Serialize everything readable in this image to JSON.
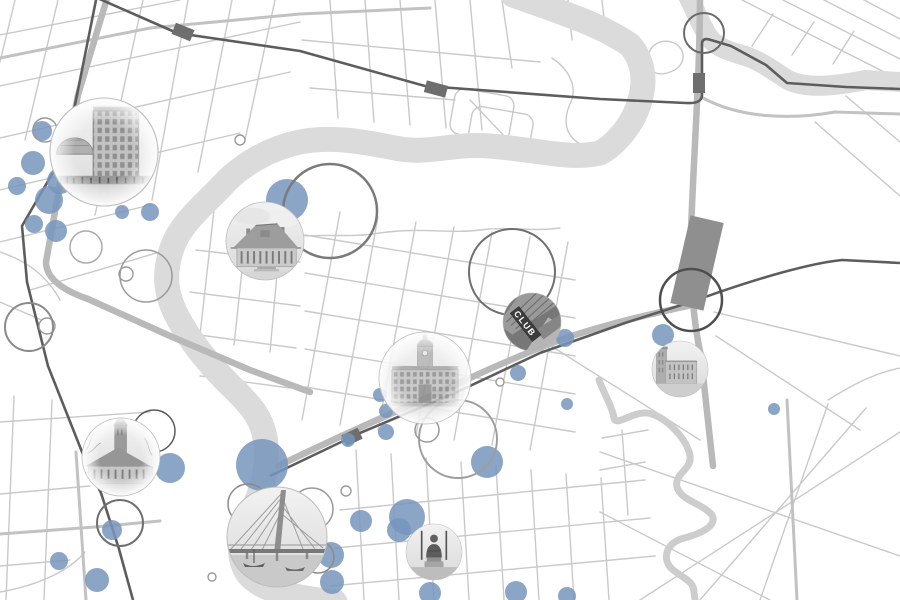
{
  "canvas": {
    "width": 900,
    "height": 600
  },
  "club_sign_text": "CLUB",
  "colors": {
    "background": "#ffffff",
    "bubble": "#7795bd",
    "river": "#dbdbdb",
    "railway": "#5d5d5d",
    "road_thin": "#c9c9c9",
    "road_medium": "#c2c2c2",
    "road_thick": "#b9b9b9",
    "station": "#6e6e6e",
    "dark_block": "#8f8f8f",
    "photo_edge": "#bdbdbd"
  },
  "bubbles": [
    [
      42,
      131,
      10
    ],
    [
      33,
      163,
      12
    ],
    [
      61,
      165,
      7
    ],
    [
      17,
      186,
      9
    ],
    [
      60,
      181,
      13
    ],
    [
      49,
      200,
      14
    ],
    [
      34,
      224,
      9
    ],
    [
      56,
      231,
      11
    ],
    [
      97,
      197,
      8
    ],
    [
      122,
      212,
      7
    ],
    [
      150,
      212,
      9
    ],
    [
      287,
      200,
      21
    ],
    [
      380,
      395,
      7
    ],
    [
      386,
      411,
      7
    ],
    [
      386,
      432,
      8
    ],
    [
      348,
      440,
      7
    ],
    [
      565,
      338,
      9
    ],
    [
      518,
      373,
      8
    ],
    [
      567,
      404,
      6
    ],
    [
      663,
      335,
      11
    ],
    [
      774,
      409,
      6
    ],
    [
      170,
      468,
      15
    ],
    [
      262,
      465,
      26
    ],
    [
      112,
      530,
      10
    ],
    [
      59,
      561,
      9
    ],
    [
      97,
      580,
      12
    ],
    [
      331,
      555,
      13
    ],
    [
      332,
      582,
      12
    ],
    [
      407,
      517,
      18
    ],
    [
      399,
      530,
      12
    ],
    [
      361,
      521,
      11
    ],
    [
      487,
      462,
      16
    ],
    [
      430,
      593,
      11
    ],
    [
      516,
      592,
      11
    ],
    [
      567,
      596,
      9
    ]
  ],
  "rings": [
    [
      704,
      33,
      20,
      2,
      "#6b6b6b"
    ],
    [
      330,
      211,
      47,
      2.5,
      "#7a7a7a"
    ],
    [
      512,
      272,
      43,
      2,
      "#6f6f6f"
    ],
    [
      691,
      300,
      31,
      2.5,
      "#4e4e4e"
    ],
    [
      146,
      276,
      26,
      1.5,
      "#9a9a9a"
    ],
    [
      86,
      247,
      16,
      1.5,
      "#ababab"
    ],
    [
      29,
      327,
      24,
      2,
      "#8a8a8a"
    ],
    [
      45,
      130,
      12,
      1.5,
      "#9a9a9a"
    ],
    [
      154,
      431,
      21,
      1.5,
      "#5a5a5a"
    ],
    [
      458,
      439,
      39,
      2,
      "#9e9e9e"
    ],
    [
      120,
      523,
      23,
      2,
      "#6f6f6f"
    ],
    [
      248,
      504,
      20,
      1.5,
      "#8a8a8a"
    ],
    [
      312,
      509,
      21,
      1.5,
      "#9a9a9a"
    ],
    [
      318,
      557,
      16,
      1.5,
      "#8a8a8a"
    ],
    [
      427,
      430,
      12,
      1.5,
      "#9a9a9a"
    ]
  ],
  "roundabouts": [
    [
      240,
      140,
      5
    ],
    [
      346,
      491,
      5
    ],
    [
      212,
      577,
      4
    ],
    [
      126,
      274,
      7
    ],
    [
      47,
      326,
      8
    ],
    [
      500,
      382,
      4
    ]
  ],
  "stations": [
    [
      183,
      32,
      20,
      12,
      22
    ],
    [
      436,
      89,
      22,
      12,
      15
    ],
    [
      699,
      83,
      12,
      20,
      0
    ],
    [
      352,
      437,
      18,
      12,
      -25
    ]
  ],
  "photo_markers": [
    {
      "name": "office-building",
      "kind": "office",
      "x": 104,
      "y": 152,
      "r": 54,
      "fade": true,
      "opacity": 1
    },
    {
      "name": "heritage-house",
      "kind": "house",
      "x": 265,
      "y": 241,
      "r": 39,
      "fade": false,
      "opacity": 1
    },
    {
      "name": "domed-hall",
      "kind": "cityhall",
      "x": 425,
      "y": 378,
      "r": 46,
      "fade": true,
      "opacity": 0.88
    },
    {
      "name": "club-building",
      "kind": "club",
      "x": 532,
      "y": 322,
      "r": 29,
      "fade": false,
      "opacity": 1
    },
    {
      "name": "brick-school",
      "kind": "school",
      "x": 680,
      "y": 369,
      "r": 28,
      "fade": false,
      "opacity": 1
    },
    {
      "name": "church",
      "kind": "churchtower",
      "x": 121,
      "y": 457,
      "r": 39,
      "fade": true,
      "opacity": 1
    },
    {
      "name": "cable-bridge",
      "kind": "bridge",
      "x": 277,
      "y": 537,
      "r": 50,
      "fade": false,
      "opacity": 1
    },
    {
      "name": "statue-monument",
      "kind": "statue",
      "x": 434,
      "y": 552,
      "r": 28,
      "fade": false,
      "opacity": 1
    }
  ]
}
